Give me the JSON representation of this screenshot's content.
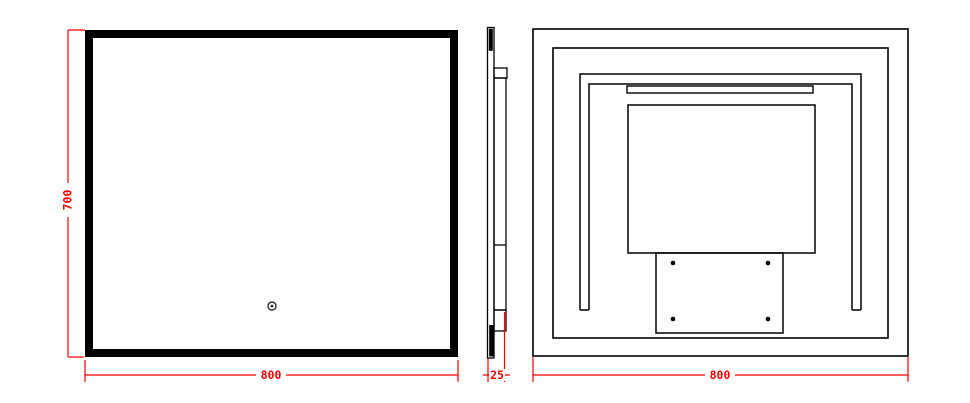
{
  "drawing": {
    "front_view": {
      "height_label": "700",
      "width_label": "800"
    },
    "side_view": {
      "depth_label": "25"
    },
    "back_view": {
      "width_label": "800"
    },
    "icons": {
      "touch_sensor": "double-circle"
    },
    "colors": {
      "line": "#000000",
      "dimension": "#ff0000",
      "background": "#ffffff"
    }
  }
}
